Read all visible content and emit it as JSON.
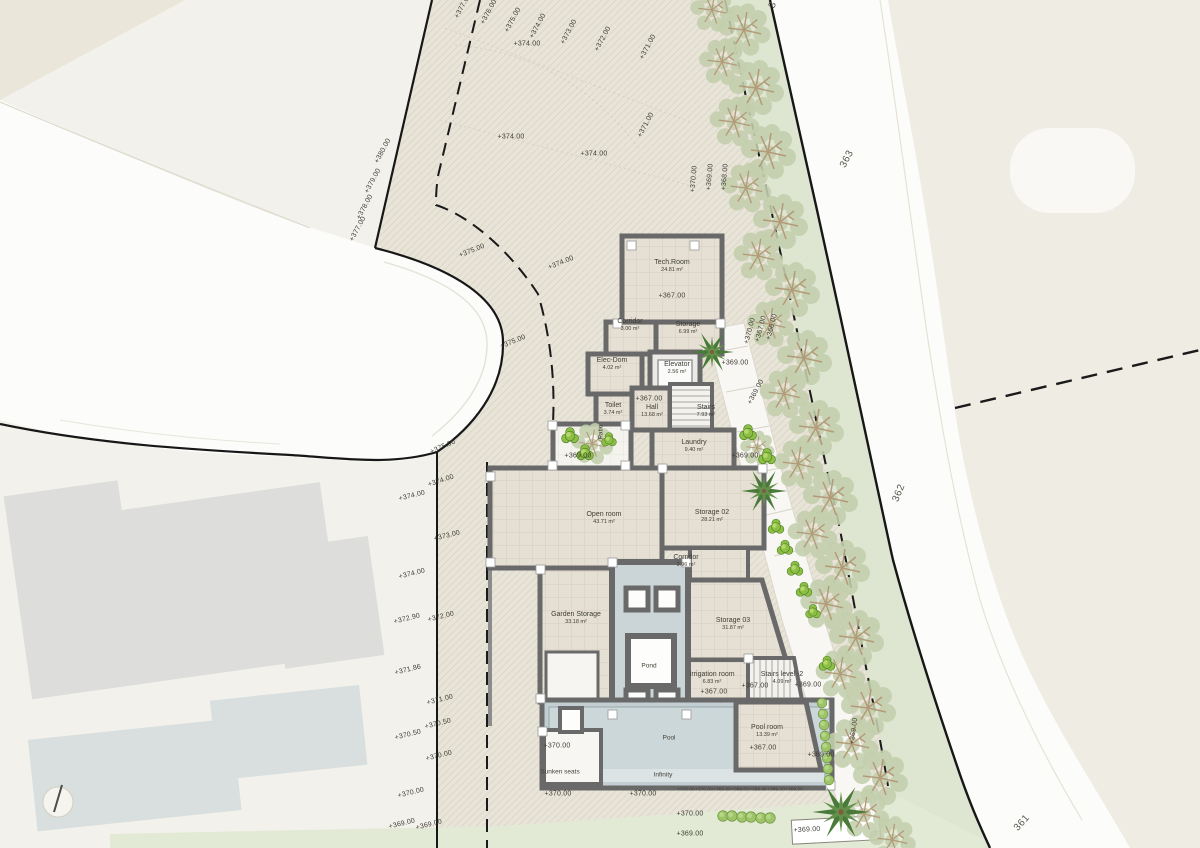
{
  "plan": {
    "colors": {
      "plot_fill": "#e8e4d8",
      "outside_fill": "#f3f1eb",
      "road_fill": "#fcfcfa",
      "water": "#ccd7d9",
      "wall": "#696969",
      "olive_foliage": "#c3cfad",
      "bright_bush": "#8cbf44",
      "grass": "#e2e9d4"
    },
    "rooms": [
      {
        "name": "Tech.Room",
        "area": "24.81 m²",
        "x": 672,
        "y": 266
      },
      {
        "name": "Corridor",
        "area": "3.00 m²",
        "x": 630,
        "y": 325
      },
      {
        "name": "Storage",
        "area": "6.99 m²",
        "x": 688,
        "y": 328
      },
      {
        "name": "Elec-Dom",
        "area": "4.02 m²",
        "x": 612,
        "y": 364
      },
      {
        "name": "Elevator",
        "area": "2.56 m²",
        "x": 677,
        "y": 368
      },
      {
        "name": "Toilet",
        "area": "3.74 m²",
        "x": 613,
        "y": 409
      },
      {
        "name": "Hall",
        "area": "13.68 m²",
        "x": 652,
        "y": 411
      },
      {
        "name": "Stairs",
        "area": "7.93 m²",
        "x": 706,
        "y": 411
      },
      {
        "name": "Laundry",
        "area": "9.40 m²",
        "x": 694,
        "y": 446
      },
      {
        "name": "Open room",
        "area": "43.71 m²",
        "x": 604,
        "y": 518
      },
      {
        "name": "Storage 02",
        "area": "28.21 m²",
        "x": 712,
        "y": 516
      },
      {
        "name": "Corridor",
        "area": "2.96 m²",
        "x": 686,
        "y": 561
      },
      {
        "name": "Garden Storage",
        "area": "33.18 m²",
        "x": 576,
        "y": 618
      },
      {
        "name": "Storage 03",
        "area": "31.87 m²",
        "x": 733,
        "y": 624
      },
      {
        "name": "Irrigation room",
        "area": "6.83 m²",
        "x": 712,
        "y": 678
      },
      {
        "name": "Stairs level -2",
        "area": "4.09 m²",
        "x": 782,
        "y": 678
      },
      {
        "name": "Pool room",
        "area": "13.39 m²",
        "x": 767,
        "y": 731
      }
    ],
    "feature_labels": [
      {
        "text": "Pond",
        "x": 649,
        "y": 666
      },
      {
        "text": "Pool",
        "x": 669,
        "y": 738
      },
      {
        "text": "Infinity",
        "x": 663,
        "y": 775
      },
      {
        "text": "Sunken seats",
        "x": 560,
        "y": 772
      },
      {
        "text": "Patio",
        "x": 601,
        "y": 432,
        "rot": -90
      }
    ],
    "road_labels": [
      {
        "text": "363",
        "x": 847,
        "y": 159,
        "rot": -62
      },
      {
        "text": "362",
        "x": 899,
        "y": 493,
        "rot": -68
      },
      {
        "text": "361",
        "x": 1022,
        "y": 823,
        "rot": -48
      },
      {
        "text": "3",
        "x": 773,
        "y": 5,
        "rot": -70
      }
    ],
    "elevation_labels": [
      {
        "text": "+377.00",
        "x": 463,
        "y": 6,
        "rot": -62
      },
      {
        "text": "+376.00",
        "x": 489,
        "y": 12,
        "rot": -62
      },
      {
        "text": "+375.00",
        "x": 513,
        "y": 20,
        "rot": -62
      },
      {
        "text": "+374.00",
        "x": 538,
        "y": 26,
        "rot": -62
      },
      {
        "text": "+373.00",
        "x": 569,
        "y": 32,
        "rot": -62
      },
      {
        "text": "+372.00",
        "x": 603,
        "y": 39,
        "rot": -62
      },
      {
        "text": "+371.00",
        "x": 648,
        "y": 47,
        "rot": -62
      },
      {
        "text": "+374.00",
        "x": 527,
        "y": 44,
        "rot": 0
      },
      {
        "text": "+374.00",
        "x": 511,
        "y": 137,
        "rot": 0
      },
      {
        "text": "+374.00",
        "x": 594,
        "y": 154,
        "rot": 0
      },
      {
        "text": "+371.00",
        "x": 646,
        "y": 125,
        "rot": -62
      },
      {
        "text": "+370.00",
        "x": 694,
        "y": 179,
        "rot": -85
      },
      {
        "text": "+369.00",
        "x": 710,
        "y": 177,
        "rot": -85
      },
      {
        "text": "+368.00",
        "x": 725,
        "y": 177,
        "rot": -85
      },
      {
        "text": "+380.00",
        "x": 383,
        "y": 151,
        "rot": -62
      },
      {
        "text": "+379.00",
        "x": 373,
        "y": 181,
        "rot": -62
      },
      {
        "text": "+378.00",
        "x": 365,
        "y": 207,
        "rot": -62
      },
      {
        "text": "+377.00",
        "x": 358,
        "y": 229,
        "rot": -62
      },
      {
        "text": "+375.00",
        "x": 472,
        "y": 251,
        "rot": -22
      },
      {
        "text": "+374.00",
        "x": 561,
        "y": 263,
        "rot": -22
      },
      {
        "text": "+375.00",
        "x": 513,
        "y": 342,
        "rot": -22
      },
      {
        "text": "+375.00",
        "x": 443,
        "y": 447,
        "rot": -24
      },
      {
        "text": "+374.00",
        "x": 441,
        "y": 481,
        "rot": -18
      },
      {
        "text": "+373.00",
        "x": 447,
        "y": 536,
        "rot": -14
      },
      {
        "text": "+372.00",
        "x": 441,
        "y": 617,
        "rot": -14
      },
      {
        "text": "+371.00",
        "x": 440,
        "y": 700,
        "rot": -14
      },
      {
        "text": "+370.50",
        "x": 438,
        "y": 724,
        "rot": -14
      },
      {
        "text": "+370.00",
        "x": 439,
        "y": 756,
        "rot": -14
      },
      {
        "text": "+374.00",
        "x": 412,
        "y": 496,
        "rot": -14
      },
      {
        "text": "+374.00",
        "x": 412,
        "y": 574,
        "rot": -14
      },
      {
        "text": "+372.90",
        "x": 407,
        "y": 619,
        "rot": -14
      },
      {
        "text": "+371.86",
        "x": 408,
        "y": 670,
        "rot": -14
      },
      {
        "text": "+370.50",
        "x": 408,
        "y": 735,
        "rot": -14
      },
      {
        "text": "+370.00",
        "x": 411,
        "y": 793,
        "rot": -14
      },
      {
        "text": "+369.00",
        "x": 402,
        "y": 824,
        "rot": -14
      },
      {
        "text": "+369.00",
        "x": 429,
        "y": 825,
        "rot": -14
      },
      {
        "text": "+370.00",
        "x": 750,
        "y": 331,
        "rot": -75
      },
      {
        "text": "+367.00",
        "x": 761,
        "y": 329,
        "rot": -75
      },
      {
        "text": "+366.00",
        "x": 772,
        "y": 327,
        "rot": -75
      },
      {
        "text": "+369.00",
        "x": 735,
        "y": 363,
        "rot": 0
      },
      {
        "text": "+369.00",
        "x": 756,
        "y": 392,
        "rot": -62
      },
      {
        "text": "+369.00",
        "x": 745,
        "y": 456,
        "rot": 0
      },
      {
        "text": "+369.00",
        "x": 578,
        "y": 456,
        "rot": 0
      },
      {
        "text": "+367.00",
        "x": 672,
        "y": 296,
        "rot": 0
      },
      {
        "text": "+367.00",
        "x": 649,
        "y": 399,
        "rot": 0
      },
      {
        "text": "+367.00",
        "x": 714,
        "y": 692,
        "rot": 0
      },
      {
        "text": "+367.00",
        "x": 755,
        "y": 686,
        "rot": 0
      },
      {
        "text": "+367.00",
        "x": 763,
        "y": 748,
        "rot": 0
      },
      {
        "text": "+369.00",
        "x": 808,
        "y": 685,
        "rot": 0
      },
      {
        "text": "+369.00",
        "x": 821,
        "y": 755,
        "rot": 0
      },
      {
        "text": "+369.00",
        "x": 854,
        "y": 731,
        "rot": -82
      },
      {
        "text": "+370.00",
        "x": 557,
        "y": 746,
        "rot": 0
      },
      {
        "text": "+370.00",
        "x": 558,
        "y": 794,
        "rot": 0
      },
      {
        "text": "+370.00",
        "x": 643,
        "y": 794,
        "rot": 0
      },
      {
        "text": "+370.00",
        "x": 686,
        "y": 790,
        "rot": 0,
        "s": 1
      },
      {
        "text": "+370.00",
        "x": 704,
        "y": 790,
        "rot": 0,
        "s": 1
      },
      {
        "text": "+369.80",
        "x": 722,
        "y": 790,
        "rot": 0,
        "s": 1
      },
      {
        "text": "+369.60",
        "x": 740,
        "y": 790,
        "rot": 0,
        "s": 1
      },
      {
        "text": "+369.40",
        "x": 758,
        "y": 790,
        "rot": 0,
        "s": 1
      },
      {
        "text": "+369.20",
        "x": 776,
        "y": 790,
        "rot": 0,
        "s": 1
      },
      {
        "text": "+369.00",
        "x": 794,
        "y": 790,
        "rot": 0,
        "s": 1
      },
      {
        "text": "+370.00",
        "x": 690,
        "y": 814,
        "rot": 0
      },
      {
        "text": "+369.00",
        "x": 690,
        "y": 834,
        "rot": 0
      },
      {
        "text": "+369.00",
        "x": 807,
        "y": 830,
        "rot": -3
      }
    ]
  }
}
